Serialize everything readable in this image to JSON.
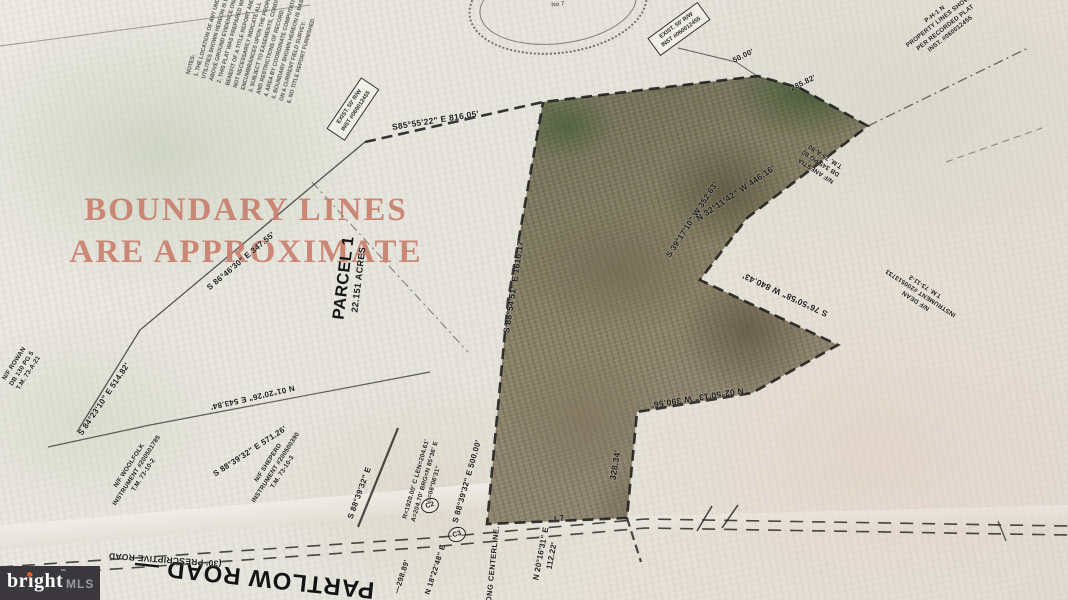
{
  "note": {
    "line1": "BOUNDARY LINES",
    "line2": "ARE APPROXIMATE",
    "color": "#c97e6c"
  },
  "parcel": {
    "name": "PARCEL 1",
    "area": "22.151 ACRES"
  },
  "bearings": {
    "top": "S85°55'22\" E 816.05'",
    "west": "S 88°54'51\" E 1616.17'",
    "ne": "N 32°11'42\" W 446.16'",
    "east_upper": "S 39°17'10\" W 352.63'",
    "east_long": "S 76°50'58\" W 840.43'",
    "south_east": "N 02°50'13\" W 390.56'",
    "south_stub": "328.34'",
    "jog_a": "50.00'",
    "jog_b": "285.82'",
    "left_a": "S 84°23'10\" E 514.82'",
    "left_b": "S 86°46'30\" E 347.55'",
    "front_a": "N 01°20'26\" E 543.84'",
    "front_b": "S 88°39'32\" E 571.26'",
    "front_c": "S 88°39'32\" E 500.00'",
    "front_d": "S 88°39'32\" E",
    "road_a": "N 18°22'48\" E",
    "road_a_len": "—298.89'",
    "road_b": "N 20°16'31\" E",
    "road_b_len": "112.22'",
    "l7": "L7"
  },
  "curve": {
    "c2": "C2",
    "c3": "C3",
    "data1": "R=1920.00' C LEN=204.61'",
    "data2": "A=204.70' BRG=N 85°36' E",
    "data3": "Δ=06°06'31\""
  },
  "road": {
    "name": "PARTLOW ROAD —",
    "type": "(30' PRESCRIPTIVE ROAD",
    "centerline": "ALONG CENTERLINE."
  },
  "owners": {
    "woolfolk": [
      "N/F WOOLFOLK",
      "INSTRUMENT #200501785",
      "T.M. 73-10-2"
    ],
    "sheperd": [
      "N/F SHEPERD",
      "INSTRUMENT #200500390",
      "T.M. 73-10-3"
    ],
    "dean": [
      "N/F DEAN",
      "INSTRUMENT #200513733",
      "T.M. 73-11-2"
    ],
    "anestia": [
      "N/F ANESTIA",
      "DB 345 PG 80",
      "T.M. 75-A-80"
    ],
    "rowan": [
      "N/F ROWAN",
      "DB 130 PG 5",
      "T.M. 73-A-21"
    ]
  },
  "easement_box": {
    "line1": "EXIST. 50' R/W",
    "line2": "INST #060012455"
  },
  "notes_topleft": [
    "NOTES:",
    "1. THE LOCATION OF ANY UNDERGROUND",
    "UTILITIES SHOWN HEREON IS BASED ON",
    "ABOVE GROUND EVIDENCE ONLY.",
    "2. THIS PLAT WAS PREPARED WITHOUT THE",
    "BENEFIT OF A TITLE REPORT AND DOES",
    "NOT NECESSARILY INDICATE ALL",
    "ENCUMBRANCES UPON THE PROPERTY.",
    "3. SUBJECT TO EASEMENTS, CONDITIONS",
    "AND RESTRICTIONS OF RECORD.",
    "4. AREA BY COORDINATE COMPUTATION.",
    "5. BOUNDARY SHOWN HEREON IS BASED",
    "ON A CURRENT FIELD SURVEY.",
    "6. NO TITLE REPORT FURNISHED."
  ],
  "notes_topright": [
    "P-H-1 N",
    "PROPERTY LINES SHOWN",
    "PER RECORDED PLAT",
    "INST. #060012455"
  ],
  "seal": {
    "center": "No 7"
  },
  "watermark": {
    "brand": "bright",
    "tm": "™",
    "suffix": "MLS",
    "bg": "#3a383c",
    "dot": "#e05a1f"
  }
}
